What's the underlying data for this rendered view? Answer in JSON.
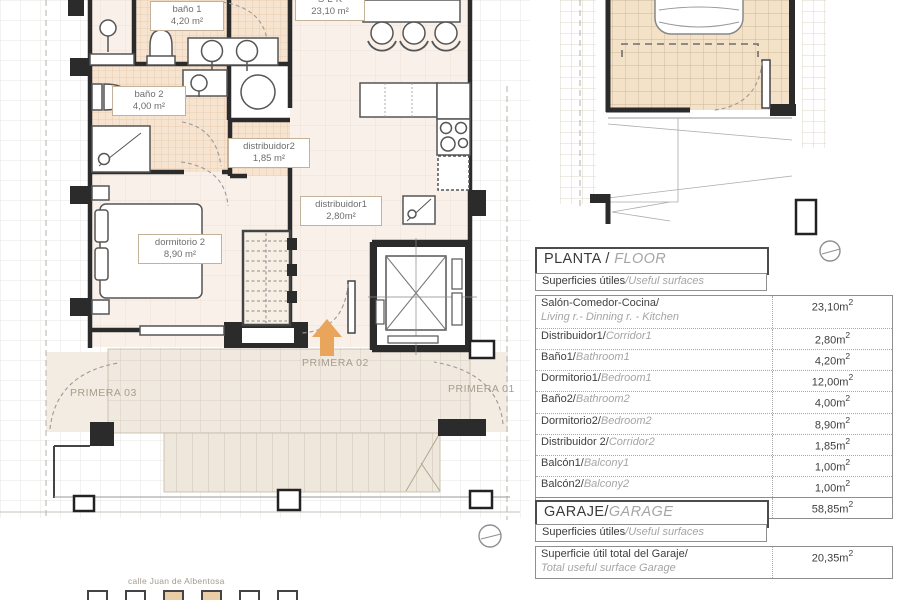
{
  "plan": {
    "room_labels": [
      {
        "name": "S-L-K",
        "area": "23,10 m²"
      },
      {
        "name": "baño 1",
        "area": "4,20 m²"
      },
      {
        "name": "baño 2",
        "area": "4,00 m²"
      },
      {
        "name": "distribuidor2",
        "area": "1,85 m²"
      },
      {
        "name": "distribuidor1",
        "area": "2,80m²"
      },
      {
        "name": "dormitorio 2",
        "area": "8,90 m²"
      }
    ],
    "zone_labels": [
      {
        "label": "PRIMERA 02"
      },
      {
        "label": "PRIMERA 03"
      },
      {
        "label": "PRIMERA 01"
      }
    ],
    "street_label": "calle Juan de Albentosa"
  },
  "units": {
    "sq": "2"
  },
  "planta": {
    "title": "PLANTA / ",
    "title_alt": "FLOOR",
    "subtitle": "Superficies útiles",
    "subtitle_alt": "/Useful surfaces",
    "rows": [
      {
        "es": "Salón-Comedor-Cocina/",
        "en": "Living r.- Dinning r. - Kitchen",
        "value": "23,10m"
      },
      {
        "es": "Distribuidor1/",
        "en": "Corridor1",
        "value": "2,80m"
      },
      {
        "es": "Baño1/",
        "en": "Bathroom1",
        "value": "4,20m"
      },
      {
        "es": "Dormitorio1/",
        "en": "Bedroom1",
        "value": "12,00m"
      },
      {
        "es": "Baño2/",
        "en": "Bathroom2",
        "value": "4,00m"
      },
      {
        "es": "Dormitorio2/",
        "en": "Bedroom2",
        "value": "8,90m"
      },
      {
        "es": "Distribuidor 2/",
        "en": "Corridor2",
        "value": "1,85m"
      },
      {
        "es": "Balcón1/",
        "en": "Balcony1",
        "value": "1,00m"
      },
      {
        "es": "Balcón2/",
        "en": "Balcony2",
        "value": "1,00m"
      }
    ],
    "total": {
      "es": "Superficie útil total / ",
      "en": "Total useful surface",
      "value": "58,85m"
    }
  },
  "garaje": {
    "title": "GARAJE/",
    "title_alt": "GARAGE",
    "subtitle": "Superficies útiles",
    "subtitle_alt": "/Useful surfaces",
    "row": {
      "es": "Superficie útil total del Garaje/",
      "en": "Total useful surface Garage",
      "value": "20,35m"
    }
  }
}
